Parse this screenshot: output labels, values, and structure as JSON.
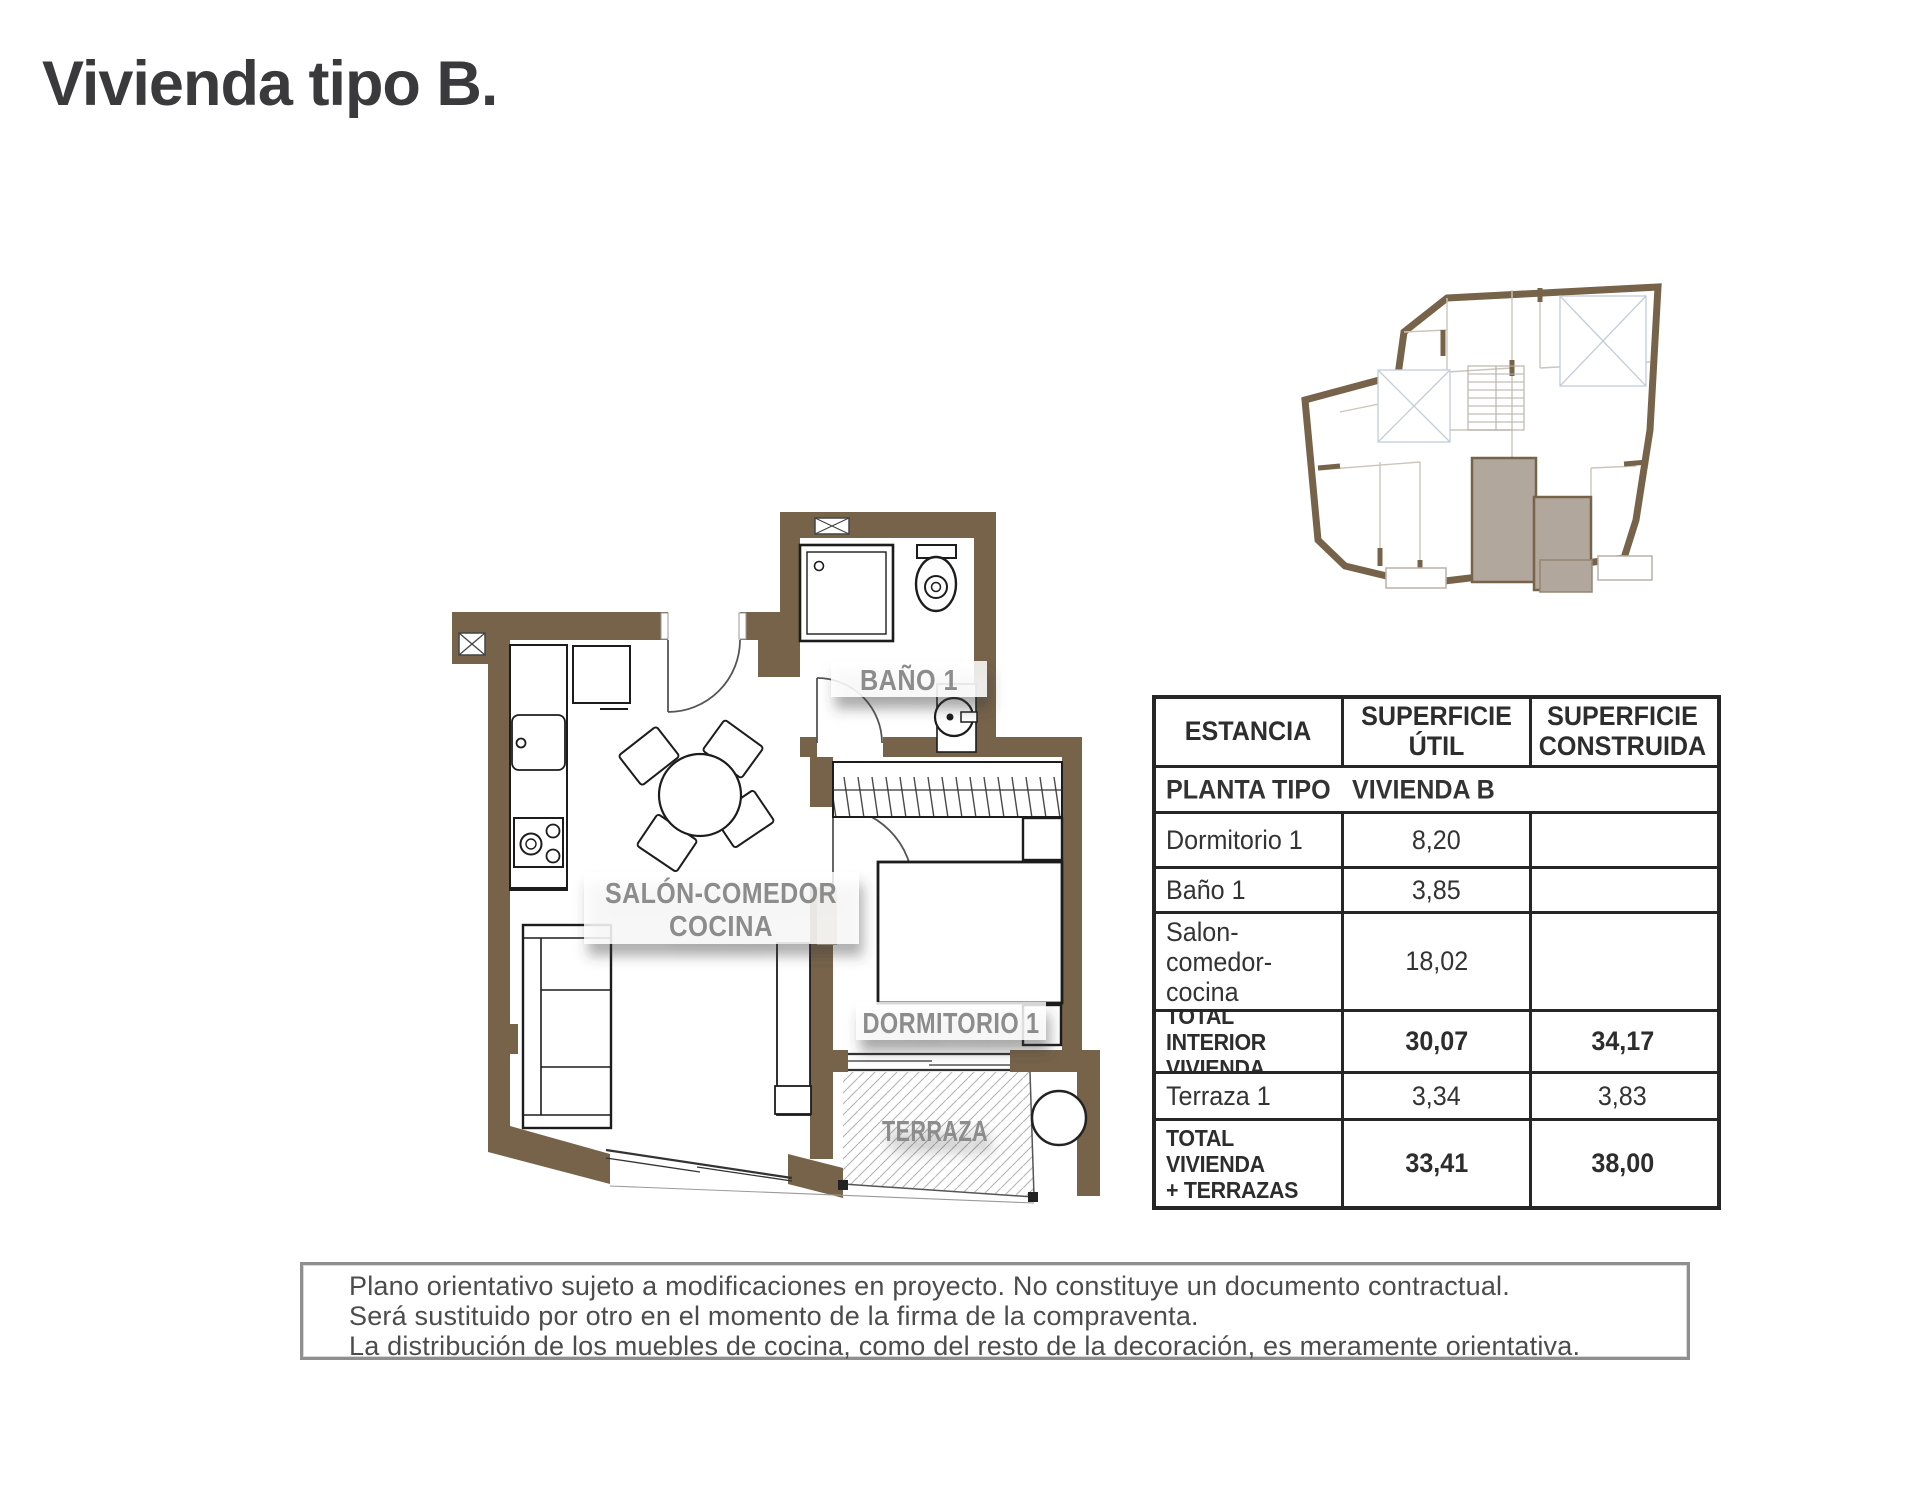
{
  "page": {
    "title": "Vivienda tipo B."
  },
  "plan": {
    "labels": {
      "salon_line1": "SALÓN-COMEDOR",
      "salon_line2": "COCINA",
      "bano": "BAÑO 1",
      "dormitorio": "DORMITORIO 1",
      "terraza": "TERRAZA"
    },
    "colors": {
      "wall_brown": "#77634a",
      "label_gray": "#8c8c8c",
      "key_plan_highlight": "#b2a79d"
    }
  },
  "table": {
    "headers": [
      "ESTANCIA",
      "SUPERFICIE ÚTIL",
      "SUPERFICIE CONSTRUIDA"
    ],
    "subheader": {
      "left": "PLANTA TIPO",
      "right": "VIVIENDA B"
    },
    "rows": [
      {
        "estancia": "Dormitorio 1",
        "util": "8,20",
        "construida": ""
      },
      {
        "estancia": "Baño 1",
        "util": "3,85",
        "construida": ""
      },
      {
        "estancia": "Salon-comedor-cocina",
        "util": "18,02",
        "construida": ""
      },
      {
        "estancia": "TOTAL INTERIOR\nVIVIENDA",
        "util": "30,07",
        "construida": "34,17"
      },
      {
        "estancia": "Terraza 1",
        "util": "3,34",
        "construida": "3,83"
      },
      {
        "estancia": "TOTAL VIVIENDA\n+ TERRAZAS",
        "util": "33,41",
        "construida": "38,00"
      }
    ]
  },
  "disclaimer": {
    "lines": [
      "Plano orientativo sujeto a modificaciones en proyecto. No constituye un documento contractual.",
      "Será sustituido por otro en el momento de la firma de la compraventa.",
      "La distribución de los muebles de cocina, como del resto de la decoración, es meramente orientativa."
    ]
  }
}
